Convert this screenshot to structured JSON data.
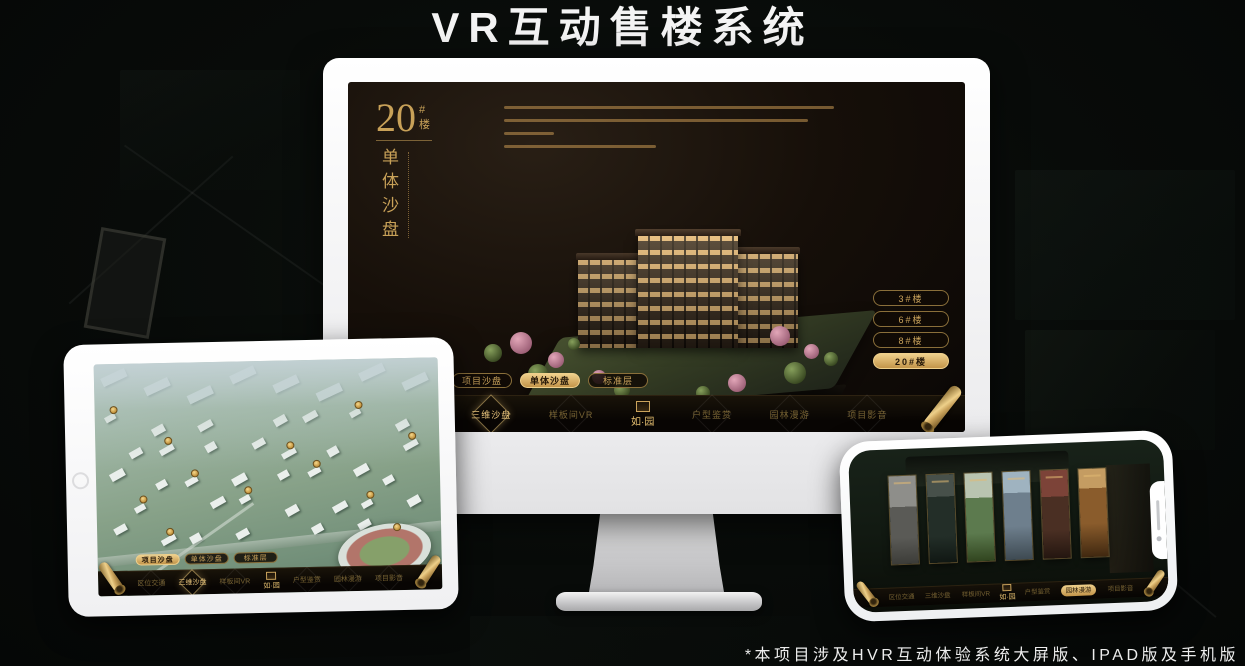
{
  "header": {
    "title": "VR互动售楼系统"
  },
  "footer": {
    "note": "*本项目涉及HVR互动体验系统大屏版、IPAD版及手机版"
  },
  "brand": {
    "logo_text": "如·园"
  },
  "colors": {
    "gold": "#c9a35c",
    "gold_bright": "#efd08c",
    "gold_deep": "#8a6f3a",
    "screen_dark": "#160f09",
    "active_text_dark": "#241708",
    "title_white": "#f4f4f4"
  },
  "monitor_ui": {
    "heading": {
      "number": "20",
      "suffix": "#楼",
      "subtitle": "单体沙盘"
    },
    "floor_buttons": [
      {
        "label": "3#楼",
        "active": false
      },
      {
        "label": "6#楼",
        "active": false
      },
      {
        "label": "8#楼",
        "active": false
      },
      {
        "label": "20#楼",
        "active": true
      }
    ],
    "mode_tabs": [
      {
        "label": "项目沙盘",
        "active": false
      },
      {
        "label": "单体沙盘",
        "active": true
      },
      {
        "label": "标准层",
        "active": false
      }
    ],
    "nav_items": [
      {
        "label": "区位交通",
        "active": false
      },
      {
        "label": "三维沙盘",
        "active": true
      },
      {
        "label": "样板间VR",
        "active": false
      },
      {
        "label": "户型鉴赏",
        "active": false
      },
      {
        "label": "园林漫游",
        "active": false
      },
      {
        "label": "项目影音",
        "active": false
      }
    ]
  },
  "tablet_ui": {
    "mode_tabs": [
      {
        "label": "项目沙盘",
        "active": true
      },
      {
        "label": "单体沙盘",
        "active": false
      },
      {
        "label": "标准层",
        "active": false
      }
    ],
    "nav_items": [
      {
        "label": "区位交通",
        "active": false
      },
      {
        "label": "三维沙盘",
        "active": true
      },
      {
        "label": "样板间VR",
        "active": false
      },
      {
        "label": "户型鉴赏",
        "active": false
      },
      {
        "label": "园林漫游",
        "active": false
      },
      {
        "label": "项目影音",
        "active": false
      }
    ]
  },
  "phone_ui": {
    "nav_items": [
      {
        "label": "区位交通",
        "active": false
      },
      {
        "label": "三维沙盘",
        "active": false
      },
      {
        "label": "样板间VR",
        "active": false
      },
      {
        "label": "户型鉴赏",
        "active": false
      },
      {
        "label": "园林漫游",
        "active": true
      },
      {
        "label": "项目影音",
        "active": false
      }
    ],
    "gallery_count": 6
  }
}
